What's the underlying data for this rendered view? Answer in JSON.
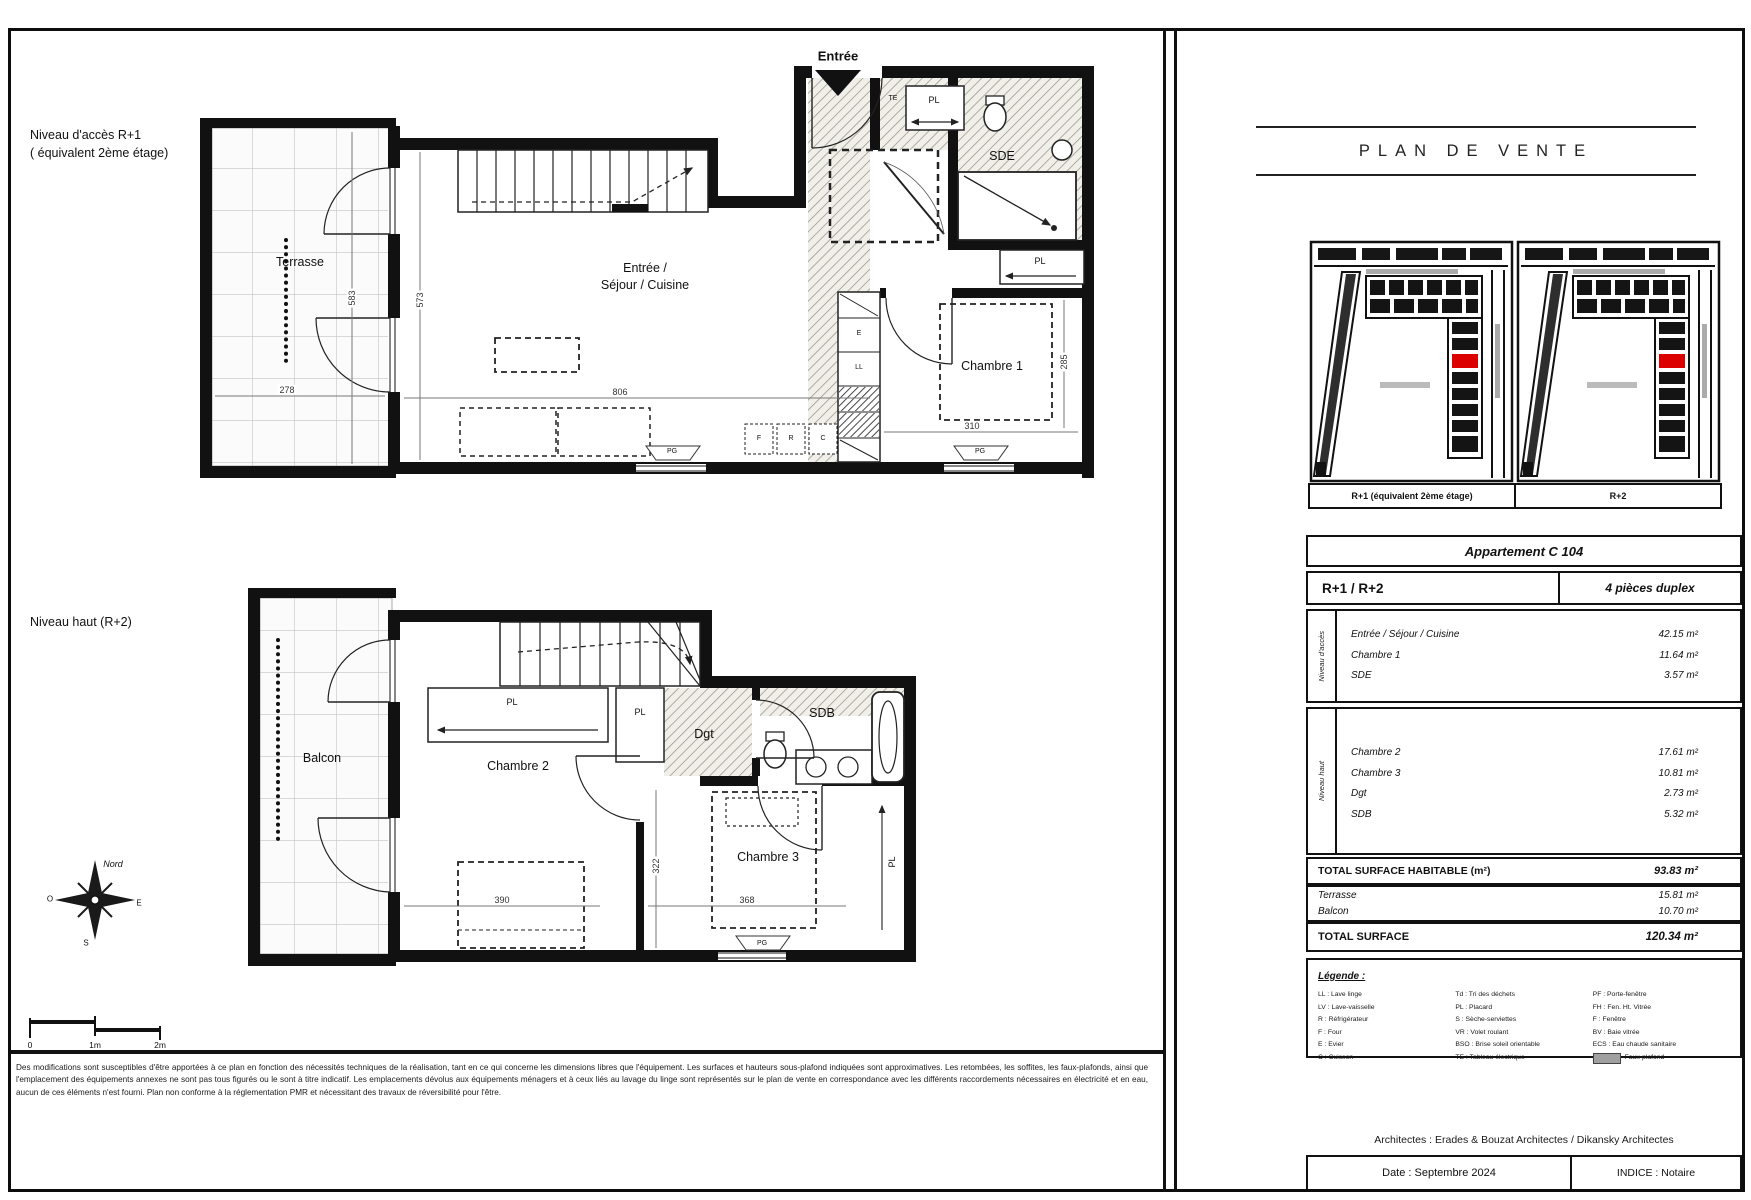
{
  "sheet": {
    "title": "PLAN DE VENTE"
  },
  "colors": {
    "highlight_red": "#dd0000",
    "wall": "#111111"
  },
  "levels": {
    "upper_title_line1": "Niveau d'accès R+1",
    "upper_title_line2": "( équivalent 2ème étage)",
    "lower_title": "Niveau haut (R+2)"
  },
  "upper_plan": {
    "entree": "Entrée",
    "terrasse": "Terrasse",
    "sejour_line1": "Entrée /",
    "sejour_line2": "Séjour / Cuisine",
    "chambre1": "Chambre 1",
    "sde": "SDE",
    "dims": {
      "terrasse_width": "278",
      "terrasse_height": "583",
      "sejour_width": "806",
      "sejour_height": "573",
      "chambre1_width": "310",
      "chambre1_height": "285"
    }
  },
  "lower_plan": {
    "balcon": "Balcon",
    "chambre2": "Chambre 2",
    "chambre3": "Chambre 3",
    "dgt": "Dgt",
    "sdb": "SDB",
    "dims": {
      "chambre2_width": "390",
      "chambre3_width": "322",
      "chambre2_height": "368"
    }
  },
  "labels": {
    "pl": "PL",
    "pg": "PG",
    "te": "TE",
    "ll": "LL",
    "e": "E",
    "f": "F",
    "r": "R",
    "c": "C"
  },
  "compass": {
    "north": "Nord",
    "west": "O",
    "east": "E",
    "south": "S"
  },
  "scale": {
    "zero": "0",
    "one_m": "1m",
    "two_m": "2m"
  },
  "site_maps": {
    "left_caption": "R+1 (équivalent 2ème étage)",
    "right_caption": "R+2"
  },
  "apartment": {
    "name": "Appartement C 104",
    "levels": "R+1 / R+2",
    "type": "4 pièces duplex",
    "access_section": {
      "label": "Niveau d'accès",
      "rows": [
        {
          "name": "Entrée / Séjour / Cuisine",
          "area": "42.15 m²"
        },
        {
          "name": "Chambre 1",
          "area": "11.64 m²"
        },
        {
          "name": "SDE",
          "area": "3.57 m²"
        }
      ]
    },
    "upper_section": {
      "label": "Niveau haut",
      "rows": [
        {
          "name": "Chambre 2",
          "area": "17.61 m²"
        },
        {
          "name": "Chambre 3",
          "area": "10.81 m²"
        },
        {
          "name": "Dgt",
          "area": "2.73 m²"
        },
        {
          "name": "SDB",
          "area": "5.32 m²"
        }
      ]
    },
    "total_habitable_label": "TOTAL SURFACE HABITABLE (m²)",
    "total_habitable_value": "93.83 m²",
    "annex_rows": [
      {
        "name": "Terrasse",
        "area": "15.81 m²"
      },
      {
        "name": "Balcon",
        "area": "10.70 m²"
      }
    ],
    "total_surface_label": "TOTAL SURFACE",
    "total_surface_value": "120.34 m²"
  },
  "legend": {
    "title": "Légende :",
    "col1": [
      "LL : Lave linge",
      "LV : Lave-vaisselle",
      "R : Réfrigérateur",
      "F : Four",
      "E : Evier",
      "C : Cuisson"
    ],
    "col2": [
      "Td : Tri des déchets",
      "PL : Placard",
      "S : Sèche-serviettes",
      "VR : Volet roulant",
      "BSO : Brise soleil orientable",
      "TE : Tableau électrique"
    ],
    "col3": [
      "PF : Porte-fenêtre",
      "FH : Fen. Ht. Vitrée",
      "F : Fenêtre",
      "BV : Baie vitrée",
      "ECS : Eau chaude sanitaire"
    ],
    "swatch_label": "Faux-plafond"
  },
  "footer": {
    "architects": "Architectes : Erades & Bouzat Architectes / Dikansky Architectes",
    "date": "Date :  Septembre 2024",
    "indice": "INDICE : Notaire",
    "disclaimer": "Des modifications sont susceptibles d'être apportées à ce plan en fonction des nécessités techniques de la réalisation, tant en ce qui concerne les dimensions libres que l'équipement. Les surfaces et hauteurs sous-plafond indiquées sont approximatives. Les retombées, les soffites, les faux-plafonds, ainsi que l'emplacement des équipements annexes ne sont pas tous figurés ou le sont à titre indicatif. Les emplacements dévolus aux équipements ménagers et à ceux liés au lavage du linge sont représentés sur le plan de vente en correspondance avec les différents raccordements nécessaires en électricité et en eau, aucun de ces éléments n'est fourni. Plan non conforme à la réglementation PMR et nécessitant des travaux de réversibilité pour l'être."
  }
}
